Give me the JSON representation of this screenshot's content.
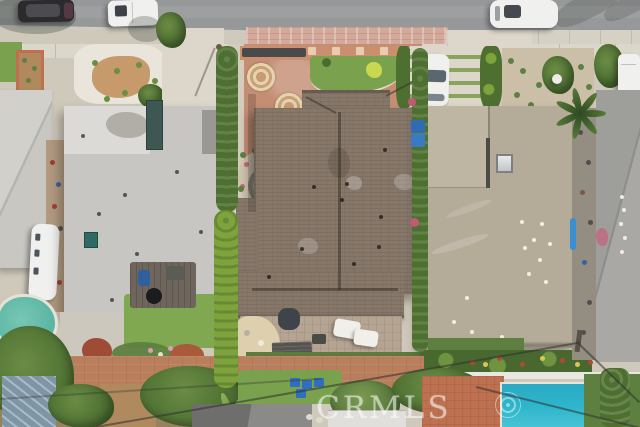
{
  "meta": {
    "domain": "Natural-Image",
    "subject": "aerial-drone-photo",
    "description": "Top-down aerial view of a suburban block: street with parked cars at top, three adjacent single-family homes (light flat roof, brown shingle hip roof, tan flat roof), landscaped front courtyards, backyard patios and lawns, a rear alley with mature trees, and two swimming pools (teal at lower left, bright cyan at lower right)."
  },
  "watermark": {
    "text": "CRMLS"
  },
  "palette": {
    "street_asphalt": "#97989a",
    "parkway_concrete": "#d6d1c5",
    "paver_pink": "#d2a99a",
    "sidewalk": "#dcd7cb",
    "concrete_light": "#dcd7ca",
    "left_roof": "#c7c6c2",
    "left_roof_white": "#dbdad6",
    "center_roof": "#867769",
    "right_roof": "#b4ab98",
    "farright_roof": "#a9a8a4",
    "neighbor_roof": "#c9c7c2",
    "courtyard": "#c48e74",
    "alley": "#b97f5c",
    "pool_deck": "#bd7150",
    "lawn": "#7aa24e",
    "lawn_dark": "#5d8040",
    "hedge": "#4d7030",
    "hedge_bright": "#7fa33c",
    "tree_dark": "#4a6c30",
    "tree_mid": "#6a8c44",
    "left_pool": "#5cb6a4",
    "right_pool": "#2fb6cb",
    "deck_wood": "#6e665d",
    "sand": "#decfae",
    "flower_wall": "#c08a64",
    "vehicle_white": "#f0f0ee",
    "vehicle_dark": "#2b2b2e",
    "shed_blue": "#7e95a6",
    "shed_gray": "#8a8a88",
    "shed_white": "#e0dfdb"
  },
  "scene": {
    "street": {
      "orientation": "horizontal-top",
      "features": [
        "asphalt",
        "curb",
        "pink-paver-parkway",
        "concrete-sidewalk"
      ]
    },
    "vehicles": [
      "dark-suv-street",
      "white-van-street",
      "white-suv-street",
      "white-car-driveway",
      "white-van-right-driveway",
      "white-rv-side-yard"
    ],
    "houses": [
      "left-house-flat-gray-roof",
      "center-house-brown-hip-roof",
      "right-house-tan-flat-roof",
      "far-left-neighbor-roof",
      "far-right-neighbor-roof"
    ],
    "pools": [
      "teal-pool-lower-left",
      "cyan-pool-lower-right"
    ],
    "landscape": [
      "xeriscape-front-yard",
      "courtyard-medallions",
      "stone-spiral-feature",
      "cypress-hedgerow",
      "ribbon-driveway",
      "backyard-lawns",
      "flower-borders",
      "palm-trees",
      "rear-alley-trees",
      "blue-adirondack-chairs"
    ]
  }
}
